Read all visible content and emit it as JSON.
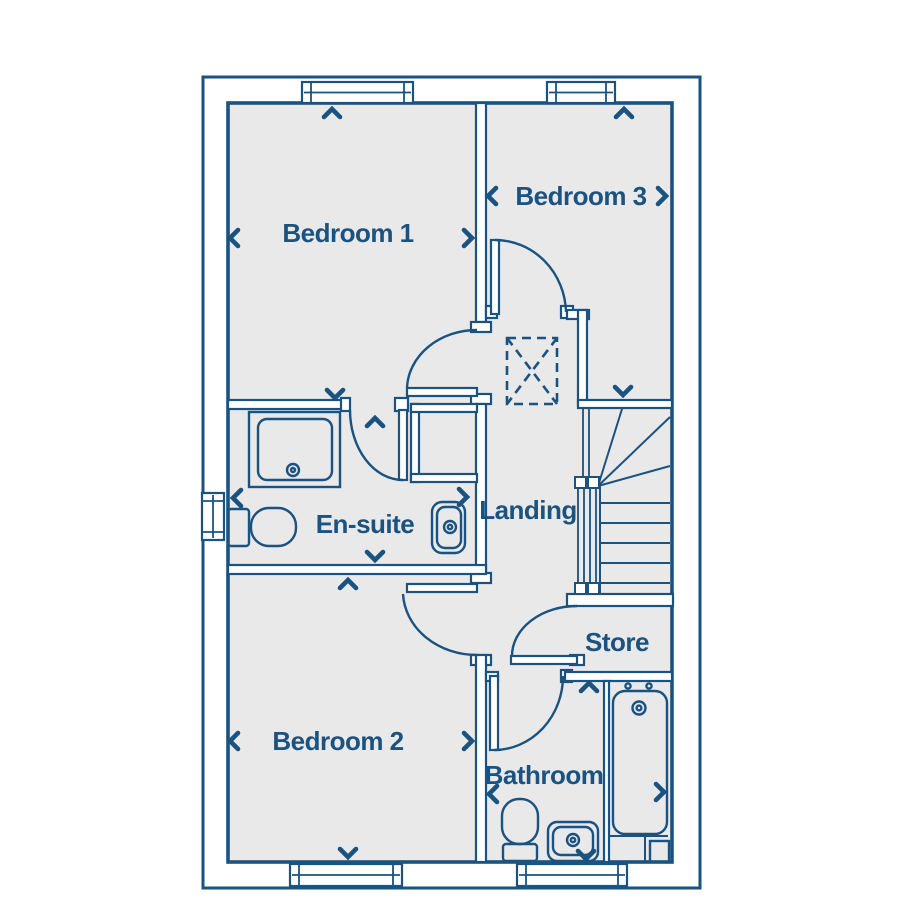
{
  "title": "First floor plan",
  "colors": {
    "line_navy": "#1a5280",
    "floor_fill": "#e9e9ea",
    "background": "#ffffff"
  },
  "plan": {
    "labels": {
      "bedroom1": "Bedroom 1",
      "bedroom3": "Bedroom 3",
      "ensuite": "En-suite",
      "landing": "Landing",
      "store": "Store",
      "bedroom2": "Bedroom 2",
      "bathroom": "Bathroom"
    },
    "rooms": [
      {
        "id": "bedroom-1",
        "label": "Bedroom 1",
        "windows": 1,
        "doors": 1,
        "dimension_arrows": [
          "up",
          "left",
          "right",
          "down"
        ]
      },
      {
        "id": "bedroom-3",
        "label": "Bedroom 3",
        "windows": 1,
        "doors": 1,
        "dimension_arrows": [
          "up",
          "left",
          "right",
          "down"
        ]
      },
      {
        "id": "en-suite",
        "label": "En-suite",
        "windows": 1,
        "doors": 1,
        "fixtures": [
          "shower",
          "toilet",
          "wash-basin"
        ],
        "dimension_arrows": [
          "up",
          "left",
          "right",
          "down"
        ]
      },
      {
        "id": "landing",
        "label": "Landing",
        "windows": 0,
        "doors": 0,
        "fixtures": [
          "staircase",
          "loft-hatch"
        ]
      },
      {
        "id": "store",
        "label": "Store",
        "windows": 0,
        "doors": 1,
        "fixtures": []
      },
      {
        "id": "bedroom-2",
        "label": "Bedroom 2",
        "windows": 1,
        "doors": 1,
        "dimension_arrows": [
          "up",
          "left",
          "right",
          "down"
        ]
      },
      {
        "id": "bathroom",
        "label": "Bathroom",
        "windows": 1,
        "doors": 1,
        "fixtures": [
          "toilet",
          "wash-basin",
          "bath"
        ],
        "dimension_arrows": [
          "up",
          "left",
          "right",
          "down"
        ]
      }
    ],
    "fixture_symbols": [
      "shower-tray",
      "toilet",
      "wash-basin",
      "bath-with-taps",
      "winder-staircase",
      "loft-hatch-dashed"
    ]
  }
}
